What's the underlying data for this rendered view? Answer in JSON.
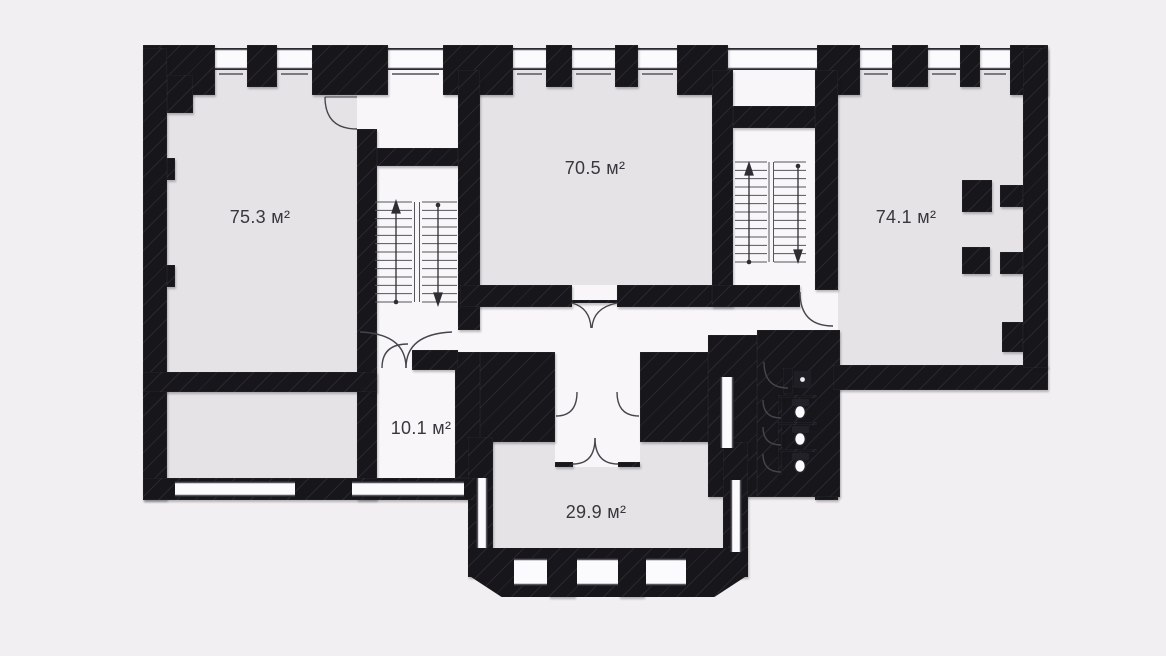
{
  "floor_plan": {
    "rooms": [
      {
        "name": "large-room-left",
        "area_label": "75.3 м²"
      },
      {
        "name": "large-room-center",
        "area_label": "70.5 м²"
      },
      {
        "name": "large-room-right",
        "area_label": "74.1 м²"
      },
      {
        "name": "small-room",
        "area_label": "10.1 м²"
      },
      {
        "name": "bay-room",
        "area_label": "29.9 м²"
      }
    ],
    "area_unit": "м²",
    "fixtures": {
      "staircases": 2,
      "wc_stalls": 3,
      "toilets": 3,
      "sinks": 1,
      "columns": 2
    },
    "colors": {
      "background": "#f2eff2",
      "wall": "#17161b",
      "room_fill": "#e5e3e6",
      "circulation_fill": "#f8f6f8",
      "line": "#46454c",
      "label_text": "#38373d"
    }
  }
}
